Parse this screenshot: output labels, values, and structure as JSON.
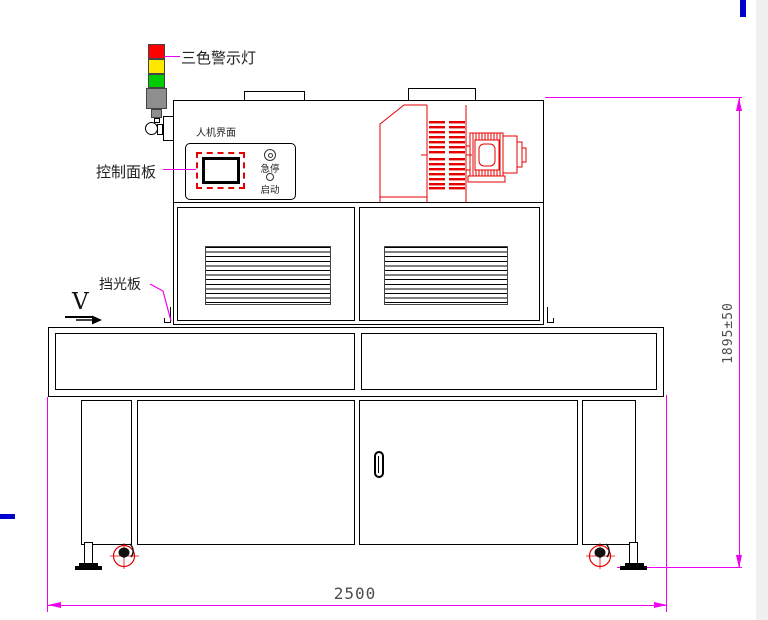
{
  "callouts": {
    "warning_light": "三色警示灯",
    "control_panel": "控制面板",
    "light_shield": "挡光板",
    "direction_symbol": "V"
  },
  "hmi": {
    "title": "人机界面",
    "emergency_stop": "急停",
    "start": "启动"
  },
  "dims": {
    "overall_width": "2500",
    "overall_height": "1895±50"
  },
  "colors": {
    "outline": "#000000",
    "component_red": "#e60000",
    "dimension_magenta": "#f000f0",
    "stray_blue": "#0000cc",
    "light_red": "#ff0000",
    "light_yellow": "#ffe800",
    "light_green": "#00cc00",
    "tower_gray": "#8f8f8f"
  }
}
